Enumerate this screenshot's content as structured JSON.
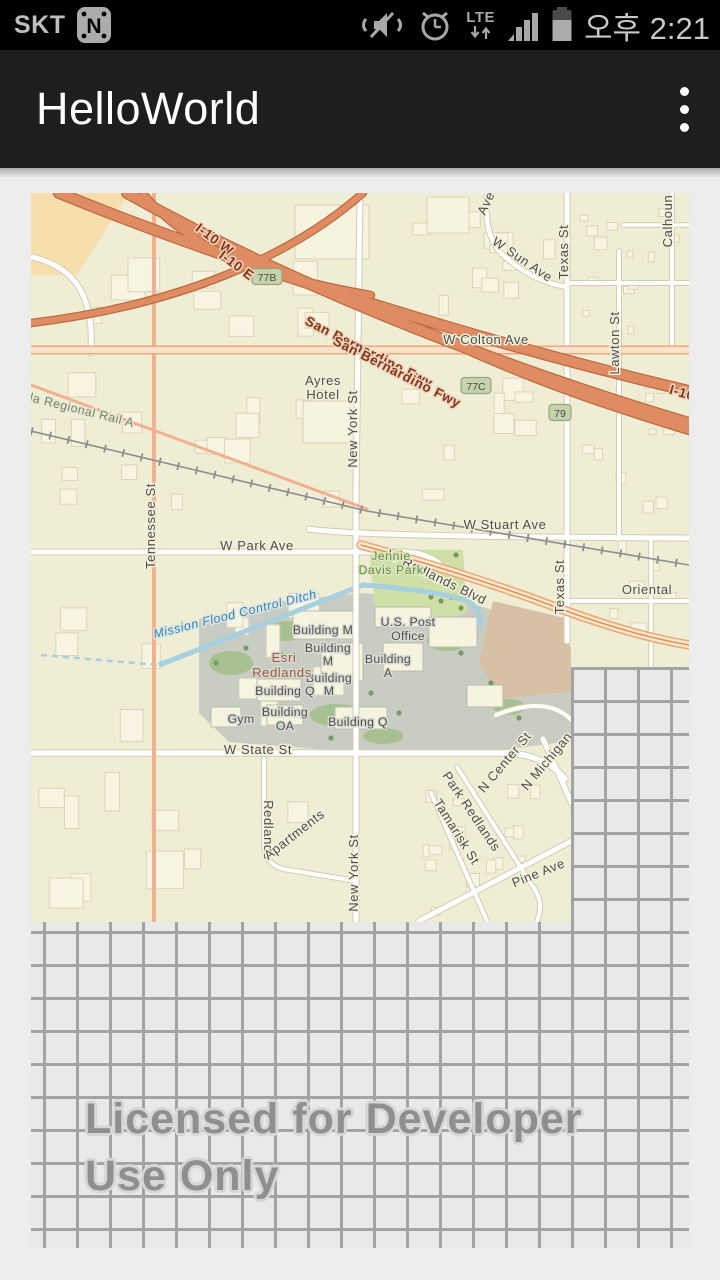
{
  "status_bar": {
    "carrier": "SKT",
    "time": "오후 2:21",
    "lte_label": "LTE"
  },
  "app_bar": {
    "title": "HelloWorld"
  },
  "map": {
    "watermark": {
      "line1": "Licensed for Developer",
      "line2": "Use Only"
    },
    "colors": {
      "map_background": "#f0edd5",
      "freeway_fill": "#e08c62",
      "freeway_casing": "#bc6a42",
      "campus_gray": "#c8ccc2",
      "park_green": "#cfe0a6",
      "water_blue": "#a6cfdf",
      "grid_line": "#a3a3a3",
      "grid_background": "#e9e9e9",
      "badge_fill": "#c6d2ad"
    },
    "badges": [
      {
        "t": "77B",
        "x": 236,
        "y": 84
      },
      {
        "t": "77C",
        "x": 445,
        "y": 193
      },
      {
        "t": "79",
        "x": 529,
        "y": 220
      }
    ],
    "labels": [
      {
        "t": "I-10 W",
        "x": 181,
        "y": 50,
        "r": 37,
        "c": "fwy"
      },
      {
        "t": "I-10 E",
        "x": 203,
        "y": 76,
        "r": 37,
        "c": "fwy"
      },
      {
        "t": "San Bernardino Fwy",
        "x": 336,
        "y": 163,
        "r": 27,
        "c": "fwy"
      },
      {
        "t": "San Bernardino Fwy",
        "x": 364,
        "y": 183,
        "r": 27,
        "c": "fwy"
      },
      {
        "t": "I-10",
        "x": 650,
        "y": 204,
        "r": 16,
        "c": "fwy",
        "a": "start"
      },
      {
        "t": "W Colton Ave",
        "x": 455,
        "y": 151
      },
      {
        "t": "Ave",
        "x": 459,
        "y": 12,
        "r": -65
      },
      {
        "t": "W Sun Ave",
        "x": 489,
        "y": 70,
        "r": 34
      },
      {
        "t": "Texas St",
        "x": 537,
        "y": 59,
        "r": -90
      },
      {
        "t": "Calhoun",
        "x": 641,
        "y": 28,
        "r": -90
      },
      {
        "t": "Lawton St",
        "x": 588,
        "y": 150,
        "r": -90
      },
      {
        "t": "W Stuart Ave",
        "x": 474,
        "y": 336
      },
      {
        "t": "W Park Ave",
        "x": 226,
        "y": 357
      },
      {
        "t": "Tennessee St",
        "x": 124,
        "y": 333,
        "r": -90
      },
      {
        "t": "New York St",
        "x": 326,
        "y": 236,
        "r": -90
      },
      {
        "t": "Texas St",
        "x": 533,
        "y": 394,
        "r": -90
      },
      {
        "t": "Oriental",
        "x": 616,
        "y": 401,
        "a": "start"
      },
      {
        "t": "W Redlands Blvd",
        "x": 404,
        "y": 388,
        "r": 26
      },
      {
        "t": "W State St",
        "x": 227,
        "y": 561
      },
      {
        "t": "Redlands",
        "x": 233,
        "y": 637,
        "r": 90
      },
      {
        "t": "Apartments",
        "x": 266,
        "y": 645,
        "r": -38
      },
      {
        "t": "New York St",
        "x": 327,
        "y": 680,
        "r": -90
      },
      {
        "t": "Park Redlands",
        "x": 437,
        "y": 621,
        "r": 56
      },
      {
        "t": "Tamarisk St",
        "x": 422,
        "y": 641,
        "r": 58
      },
      {
        "t": "N Center St",
        "x": 477,
        "y": 572,
        "r": -50
      },
      {
        "t": "N Michigan",
        "x": 519,
        "y": 571,
        "r": -50
      },
      {
        "t": "Pine Ave",
        "x": 509,
        "y": 684,
        "r": -22
      },
      {
        "t": "Ayres",
        "x": 292,
        "y": 192
      },
      {
        "t": "Hotel",
        "x": 292,
        "y": 206
      },
      {
        "t": "Jennie",
        "x": 360,
        "y": 367,
        "c": "park"
      },
      {
        "t": "Davis Park",
        "x": 360,
        "y": 381,
        "c": "park"
      },
      {
        "t": "Mission Flood Control Ditch",
        "x": 205,
        "y": 425,
        "r": -14,
        "c": "water"
      },
      {
        "t": "la Regional Rail A",
        "x": 50,
        "y": 221,
        "r": 14,
        "c": "rail"
      },
      {
        "t": "U.S. Post",
        "x": 377,
        "y": 433,
        "c": "bldg"
      },
      {
        "t": "Office",
        "x": 377,
        "y": 447,
        "c": "bldg"
      },
      {
        "t": "Building M",
        "x": 292,
        "y": 441,
        "c": "bldg"
      },
      {
        "t": "Building",
        "x": 297,
        "y": 459,
        "c": "bldg"
      },
      {
        "t": "M",
        "x": 297,
        "y": 472,
        "c": "bldg"
      },
      {
        "t": "Building",
        "x": 298,
        "y": 489,
        "c": "bldg"
      },
      {
        "t": "M",
        "x": 298,
        "y": 502,
        "c": "bldg"
      },
      {
        "t": "Building",
        "x": 357,
        "y": 470,
        "c": "bldg"
      },
      {
        "t": "A",
        "x": 357,
        "y": 484,
        "c": "bldg"
      },
      {
        "t": "Esri",
        "x": 253,
        "y": 469,
        "c": "esri"
      },
      {
        "t": "Redlands",
        "x": 251,
        "y": 484,
        "c": "esri"
      },
      {
        "t": "Building Q",
        "x": 254,
        "y": 502,
        "c": "bldg"
      },
      {
        "t": "Building",
        "x": 254,
        "y": 523,
        "c": "bldg"
      },
      {
        "t": "OA",
        "x": 254,
        "y": 537,
        "c": "bldg"
      },
      {
        "t": "Gym",
        "x": 210,
        "y": 530,
        "c": "bldg"
      },
      {
        "t": "Building Q",
        "x": 327,
        "y": 533,
        "c": "bldg"
      }
    ]
  }
}
